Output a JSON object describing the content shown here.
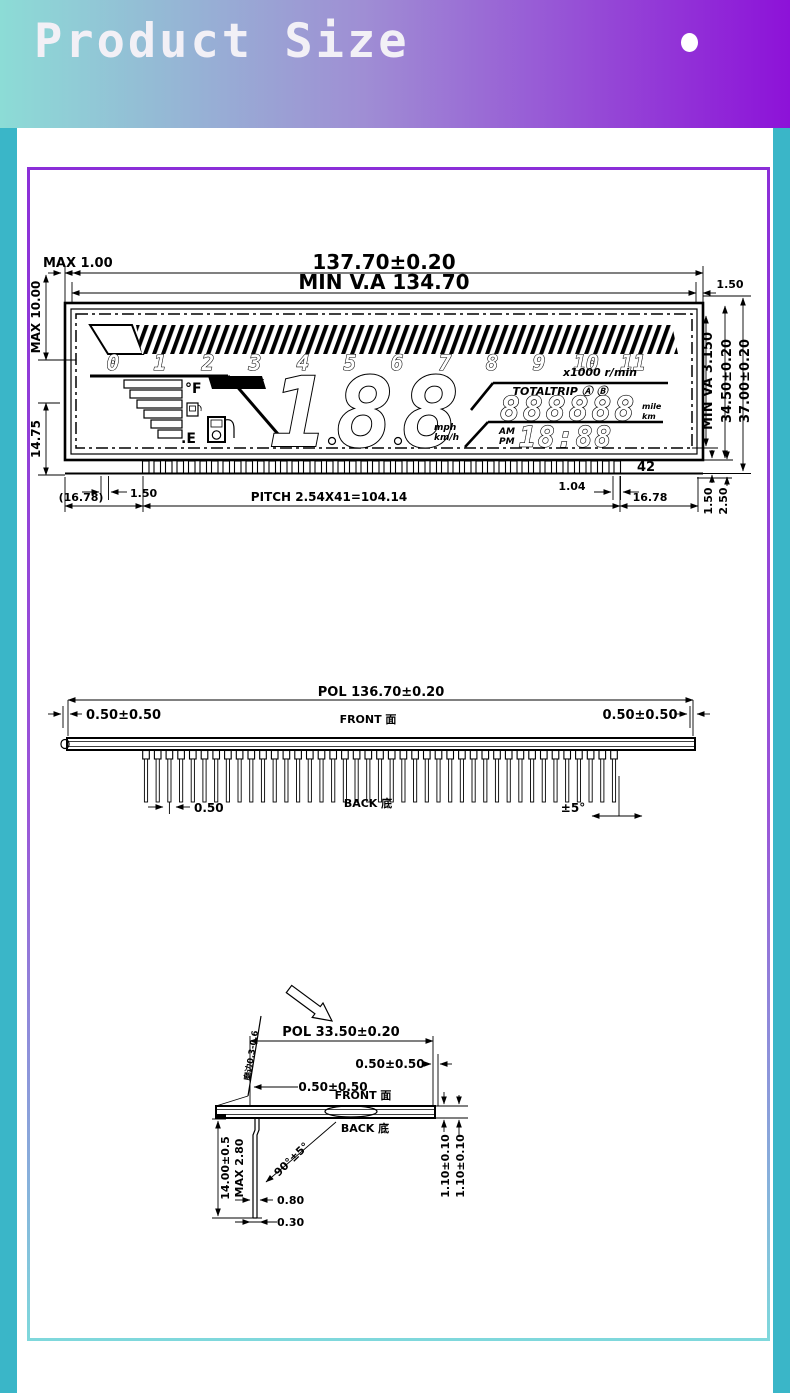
{
  "header": {
    "title": "Product Size"
  },
  "colors": {
    "banner_gradient": [
      "#8cdcd6",
      "#9f8ed4",
      "#8d12d8"
    ],
    "side_strip": "#3ab6c8",
    "frame_border_top": "#8b2fd8",
    "frame_border_bottom": "#7fd8dc",
    "line": "#000000"
  },
  "view1": {
    "dims": {
      "width": "137.70±0.20",
      "va_width": "MIN V.A 134.70",
      "max_gap": "MAX 1.00",
      "left_upper": "MAX 10.00",
      "left_lower": "14.75",
      "right_top": "1.50",
      "va_height": "MIN VA 3.150",
      "glass_height": "34.50±0.20",
      "total_height": "37.00±0.20",
      "pin_count": "42",
      "pin_left": "(16.78)",
      "first_pin": "1.50",
      "pitch": "PITCH 2.54X41=104.14",
      "last_pin": "1.04",
      "pin_right": "16.78",
      "pin_h1": "1.50",
      "pin_h2": "2.50"
    },
    "lcd": {
      "scale": [
        "0",
        "1",
        "2",
        "3",
        "4",
        "5",
        "6",
        "7",
        "8",
        "9",
        "10",
        "11"
      ],
      "scale_unit": "x1000 r/min",
      "oil_change": "OIL CHANGE",
      "fuel_full": "°F",
      "fuel_empty": ".E",
      "main_digits": "188",
      "odometer_label": "TOTALTRIP Ⓐ Ⓑ",
      "odometer_digits": "888888",
      "odo_unit_top": "mile",
      "odo_unit_bottom": "km",
      "speed_unit_top": "mph",
      "speed_unit_bottom": "km/h",
      "am": "AM",
      "pm": "PM",
      "clock": "18:88"
    }
  },
  "view2": {
    "dim_pol": "POL 136.70±0.20",
    "dim_left": "0.50±0.50",
    "dim_right": "0.50±0.50",
    "front": "FRONT 面",
    "back": "BACK 底",
    "dim_pin": "0.50",
    "dim_angle": "±5°"
  },
  "view3": {
    "edge_note": "磨边0.3-0.6",
    "dim_pol": "POL 33.50±0.20",
    "dim_right": "0.50±0.50",
    "dim_left": "0.50±0.50",
    "front": "FRONT 面",
    "back": "BACK 底",
    "dim_height": "14.00±0.5",
    "dim_max": "MAX 2.80",
    "dim_angle": "90°±5°",
    "dim_pin_w": "0.80",
    "dim_pin_tip": "0.30",
    "dim_th1": "1.10±0.10",
    "dim_th2": "1.10±0.10"
  }
}
